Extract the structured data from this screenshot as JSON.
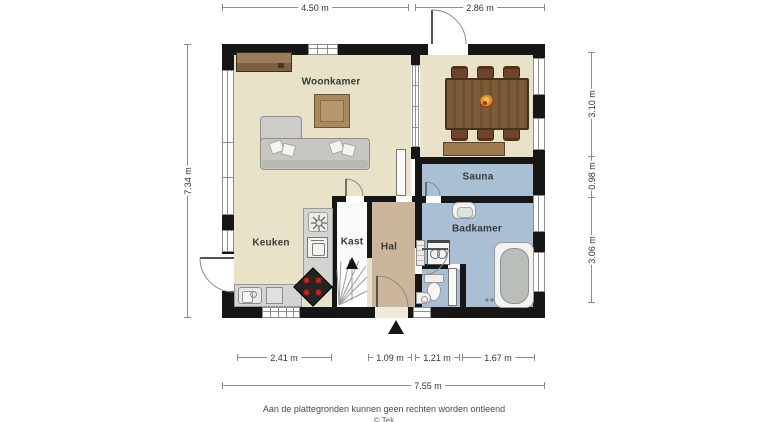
{
  "plan": {
    "rooms": {
      "woonkamer": "Woonkamer",
      "sauna": "Sauna",
      "badkamer": "Badkamer",
      "keuken": "Keuken",
      "kast": "Kast",
      "hal": "Hal"
    },
    "dimensions": {
      "top_left": "4.50 m",
      "top_right": "2.86 m",
      "left_total": "7.34 m",
      "right_top": "3.10 m",
      "right_middle": "0.98 m",
      "right_bottom": "3.06 m",
      "bottom_kitchen": "2.41 m",
      "bottom_hall": "1.09 m",
      "bottom_wc": "1.21 m",
      "bottom_bath": "1.67 m",
      "bottom_total": "7.55 m"
    },
    "footer": {
      "disclaimer": "Aan de plattegronden kunnen geen rechten worden ontleend",
      "copyright_partial": "© Tek"
    },
    "colors": {
      "wall": "#161616",
      "floor_living": "#e8e3c8",
      "floor_hall": "#cbb69b",
      "floor_wet": "#a9c0d4",
      "wood": "#7d5a39",
      "burner_red": "#c8231c"
    }
  }
}
